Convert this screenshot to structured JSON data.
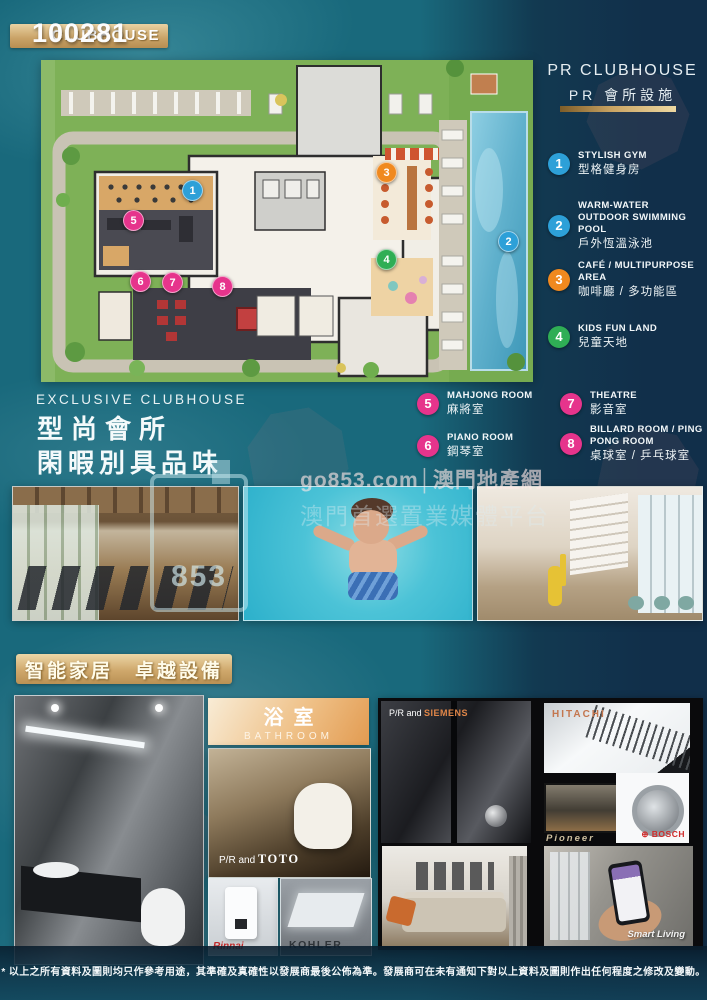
{
  "page": {
    "listing_id": "100281",
    "badge_label": "CLUBHOUSE"
  },
  "panel": {
    "title_en": "PR CLUBHOUSE",
    "title_zh": "PR 會所設施"
  },
  "legend": {
    "items": [
      {
        "num": "1",
        "en": "STYLISH GYM",
        "zh": "型格健身房",
        "color": "#2da0d8"
      },
      {
        "num": "2",
        "en": "WARM-WATER OUTDOOR SWIMMING POOL",
        "zh": "戶外恆溫泳池",
        "color": "#2da0d8"
      },
      {
        "num": "3",
        "en": "CAFÉ / MULTIPURPOSE AREA",
        "zh": "咖啡廳 / 多功能區",
        "color": "#f0891f"
      },
      {
        "num": "4",
        "en": "KIDS FUN LAND",
        "zh": "兒童天地",
        "color": "#2fae55"
      },
      {
        "num": "5",
        "en": "MAHJONG ROOM",
        "zh": "麻將室",
        "color": "#e6348c"
      },
      {
        "num": "6",
        "en": "PIANO ROOM",
        "zh": "鋼琴室",
        "color": "#e6348c"
      },
      {
        "num": "7",
        "en": "THEATRE",
        "zh": "影音室",
        "color": "#e6348c"
      },
      {
        "num": "8",
        "en": "BILLARD ROOM / PING PONG ROOM",
        "zh": "桌球室 / 乒乓球室",
        "color": "#e6348c"
      }
    ]
  },
  "clubhouse": {
    "heading_en": "EXCLUSIVE CLUBHOUSE",
    "line1": "型尚會所",
    "line2": "閑暇別具品味"
  },
  "watermark": {
    "logo_text": "853",
    "line1": "go853.com│澳門地產網",
    "line2": "澳門首選置業媒體平台"
  },
  "smart_home": {
    "banner": "智能家居　卓越設備"
  },
  "bathroom": {
    "title_zh": "浴室",
    "title_en": "BATHROOM",
    "toto_prefix": "P/R and ",
    "toto_brand": "TOTO",
    "rinnai_brand": "Rinnai",
    "kohler_brand": "KOHLER"
  },
  "appliances": {
    "siemens_prefix": "P/R and ",
    "siemens_brand": "SIEMENS",
    "hitachi_brand": "HITACHI",
    "pioneer_brand": "Pioneer",
    "bosch_icon": "⊕ ",
    "bosch_brand": "BOSCH",
    "smart_living": "Smart Living"
  },
  "footer": {
    "disclaimer": "* 以上之所有資料及圖則均只作參考用途，其準確及真確性以發展商最後公佈為準。發展商可在未有通知下對以上資料及圖則作出任何程度之修改及變動。"
  },
  "colors": {
    "legend_blue": "#2da0d8",
    "legend_orange": "#f0891f",
    "legend_green": "#2fae55",
    "legend_pink": "#e6348c",
    "gold_accent": "#d9b97e",
    "background_teal": "#19697c",
    "background_navy": "#112f4a"
  }
}
